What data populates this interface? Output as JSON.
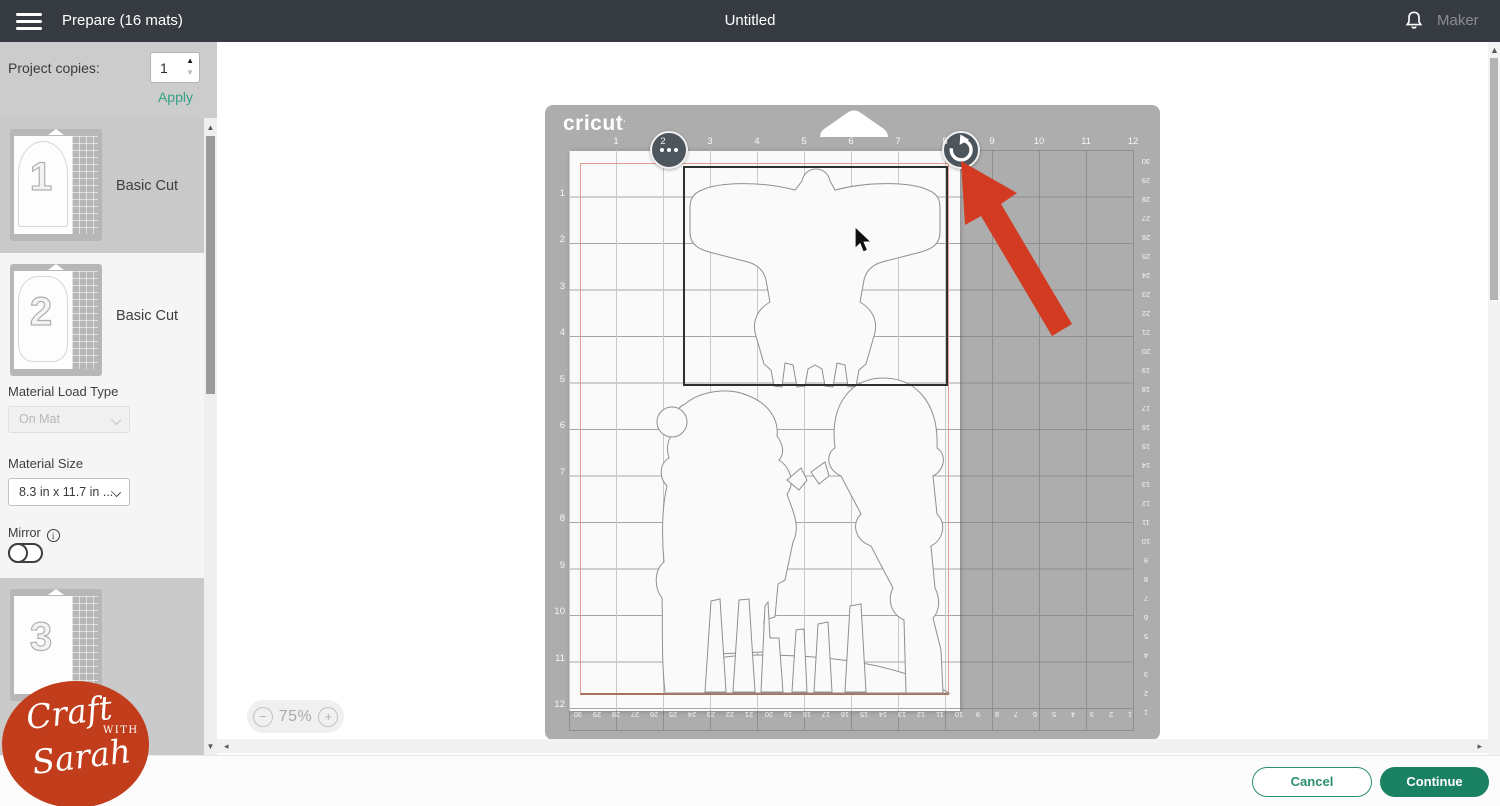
{
  "topbar": {
    "title": "Prepare (16 mats)",
    "doc_title": "Untitled",
    "machine": "Maker"
  },
  "project": {
    "copies_label": "Project copies:",
    "copies_value": "1",
    "apply": "Apply"
  },
  "mats": [
    {
      "number": "1",
      "type": "Basic Cut"
    },
    {
      "number": "2",
      "type": "Basic Cut"
    },
    {
      "number": "3",
      "type": ""
    }
  ],
  "settings": {
    "load_type_label": "Material Load Type",
    "load_type_value": "On Mat",
    "size_label": "Material Size",
    "size_value": "8.3 in x 11.7 in ...",
    "mirror_label": "Mirror",
    "info_glyph": "i"
  },
  "mat_canvas": {
    "brand": "cricut",
    "ruler_top": [
      "1",
      "2",
      "3",
      "4",
      "5",
      "6",
      "7",
      "8",
      "9",
      "10",
      "11",
      "12"
    ],
    "ruler_left": [
      "1",
      "2",
      "3",
      "4",
      "5",
      "6",
      "7",
      "8",
      "9",
      "10",
      "11",
      "12"
    ],
    "ruler_right_cm": [
      "30",
      "29",
      "28",
      "27",
      "26",
      "25",
      "24",
      "23",
      "22",
      "21",
      "20",
      "19",
      "18",
      "17",
      "16",
      "15",
      "14",
      "13",
      "12",
      "11",
      "10",
      "9",
      "8",
      "7",
      "6",
      "5",
      "4",
      "3",
      "2",
      "1"
    ],
    "ruler_bottom_cm": [
      "30",
      "29",
      "28",
      "27",
      "26",
      "25",
      "24",
      "23",
      "22",
      "21",
      "20",
      "19",
      "18",
      "17",
      "16",
      "15",
      "14",
      "13",
      "12",
      "11",
      "10",
      "9",
      "8",
      "7",
      "6",
      "5",
      "4",
      "3",
      "2",
      "1"
    ]
  },
  "zoom_control": {
    "minus": "−",
    "level": "75%",
    "plus": "+"
  },
  "footer": {
    "cancel": "Cancel",
    "continue": "Continue"
  },
  "watermark": {
    "word1": "Craft",
    "word2": "with",
    "word3": "Sarah"
  },
  "icons": {
    "up": "▲",
    "down": "▼",
    "left": "◂",
    "right": "▸"
  },
  "colors": {
    "accent_green": "#1b8163",
    "apply_green": "#35a284",
    "arrow_red": "#d23b22",
    "logo_red": "#c23d1c",
    "topbar": "#363b41",
    "mat_gray": "#adadad"
  }
}
